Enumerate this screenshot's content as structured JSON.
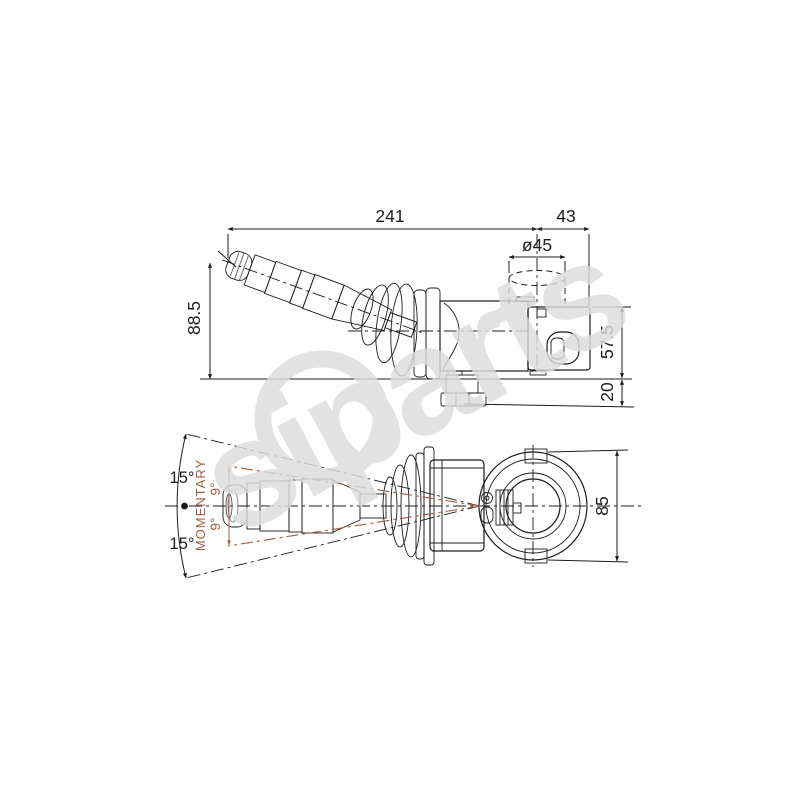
{
  "drawing": {
    "watermark_text": "siparts",
    "side_view": {
      "dim_width_total": "241",
      "dim_width_right": "43",
      "dim_diameter": "ø45",
      "dim_height_handle": "88.5",
      "dim_height_body": "57.5",
      "dim_height_connector": "20"
    },
    "bottom_view": {
      "dim_height_mount": "85",
      "angle_outer_top": "15°",
      "angle_outer_bottom": "15°",
      "angle_inner_top": "9°",
      "angle_inner_bottom": "9°",
      "momentary_label": "MOMENTARY"
    },
    "colors": {
      "line": "#1c1c1c",
      "accent_brown": "#a05f3e",
      "watermark_gray": "#d9d9d9",
      "part_light": "#dcdcdc",
      "part_dark": "#1a1a1a"
    }
  }
}
